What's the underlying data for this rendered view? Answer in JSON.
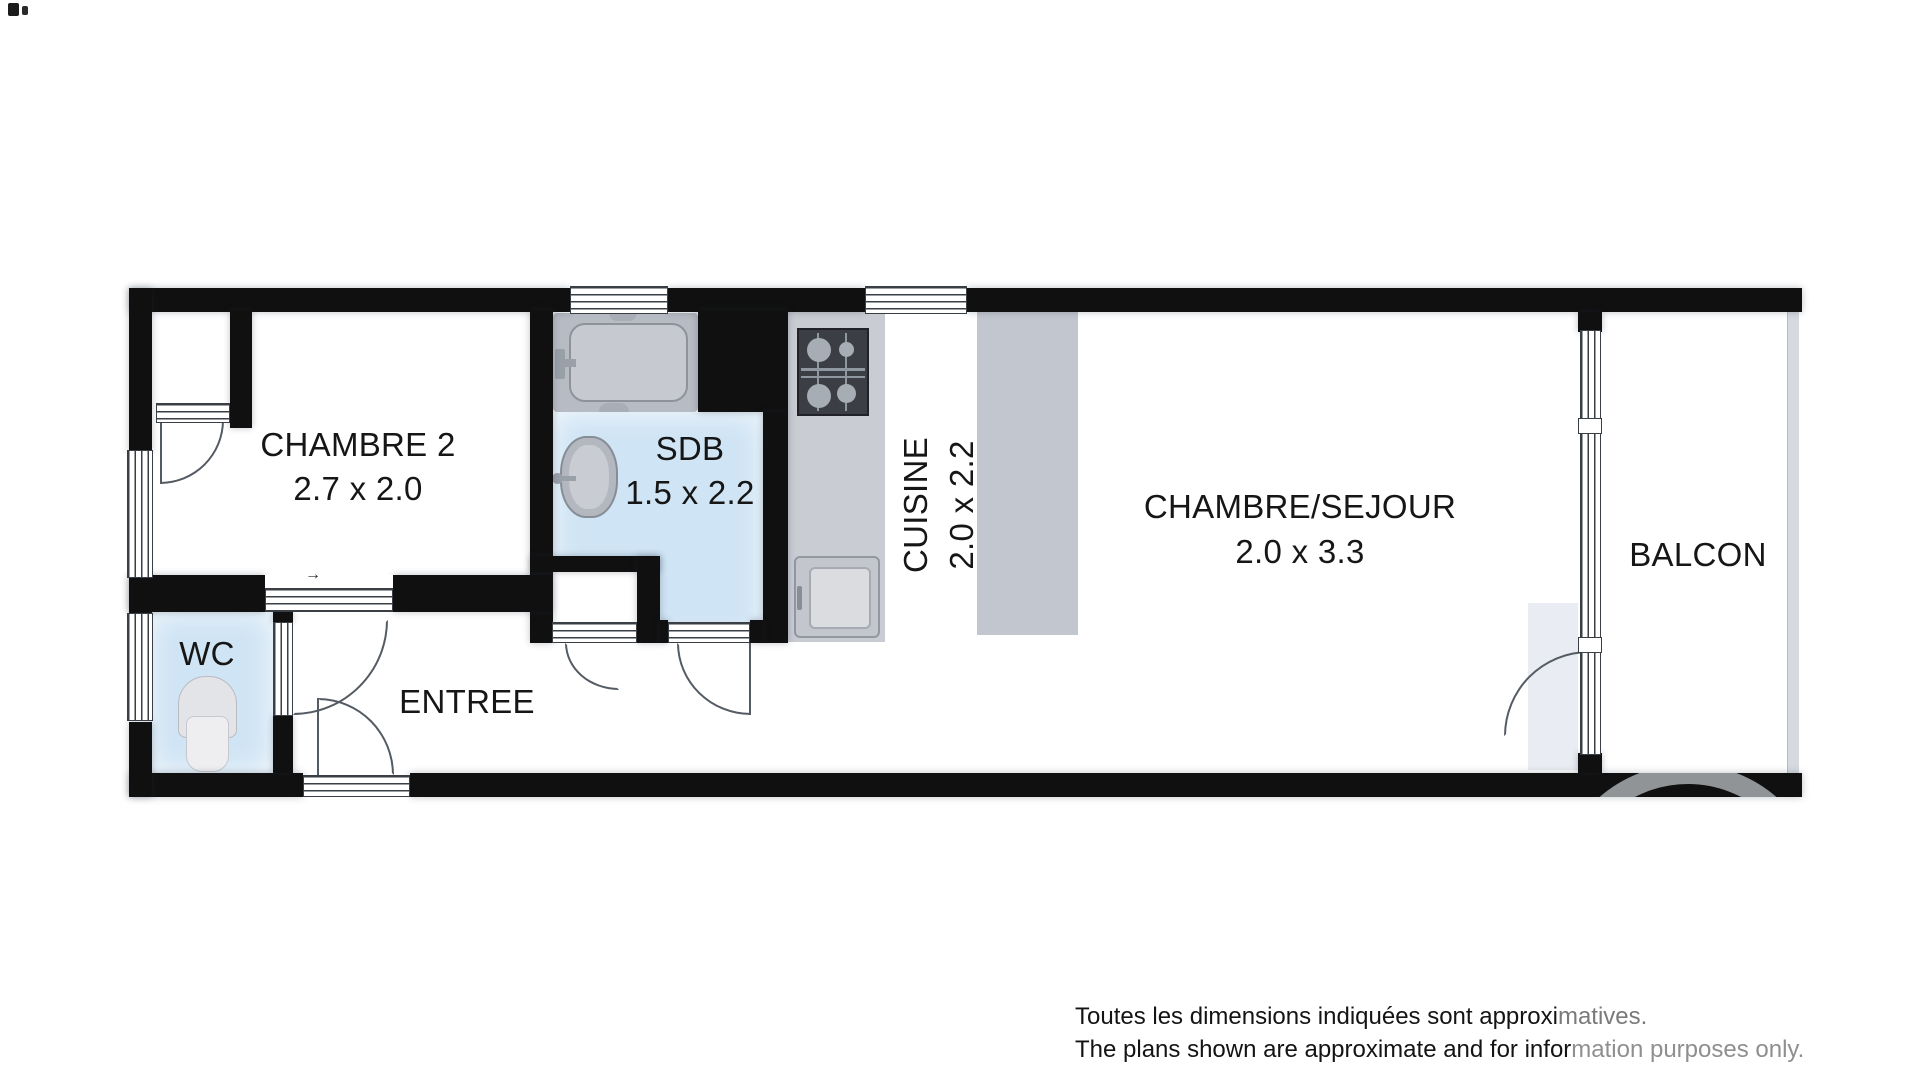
{
  "floor_plan": {
    "rooms": [
      {
        "name": "CHAMBRE 2",
        "dimensions": "2.7 x 2.0"
      },
      {
        "name": "SDB",
        "dimensions": "1.5 x 2.2"
      },
      {
        "name": "CUISINE",
        "dimensions": "2.0 x 2.2"
      },
      {
        "name": "CHAMBRE/SEJOUR",
        "dimensions": "2.0 x 3.3"
      },
      {
        "name": "BALCON"
      },
      {
        "name": "WC"
      },
      {
        "name": "ENTREE"
      }
    ],
    "sliding_door_arrow": "→",
    "fixtures": [
      "bathtub",
      "bathroom-sink",
      "toilet",
      "stove",
      "kitchen-sink",
      "wardrobe"
    ],
    "colors": {
      "wall": "#101010",
      "wet-floor": "#cfe4f4",
      "fixture": "#c5c8ce",
      "fixture-dark": "#3b3e44",
      "watermark": "#a8abaf"
    }
  },
  "disclaimer": {
    "line1": {
      "black": "Toutes les dimensions indiquées sont approxi",
      "gray": "matives."
    },
    "line2": {
      "black": "The plans shown are approximate and for infor",
      "gray": "mation purposes only."
    }
  }
}
